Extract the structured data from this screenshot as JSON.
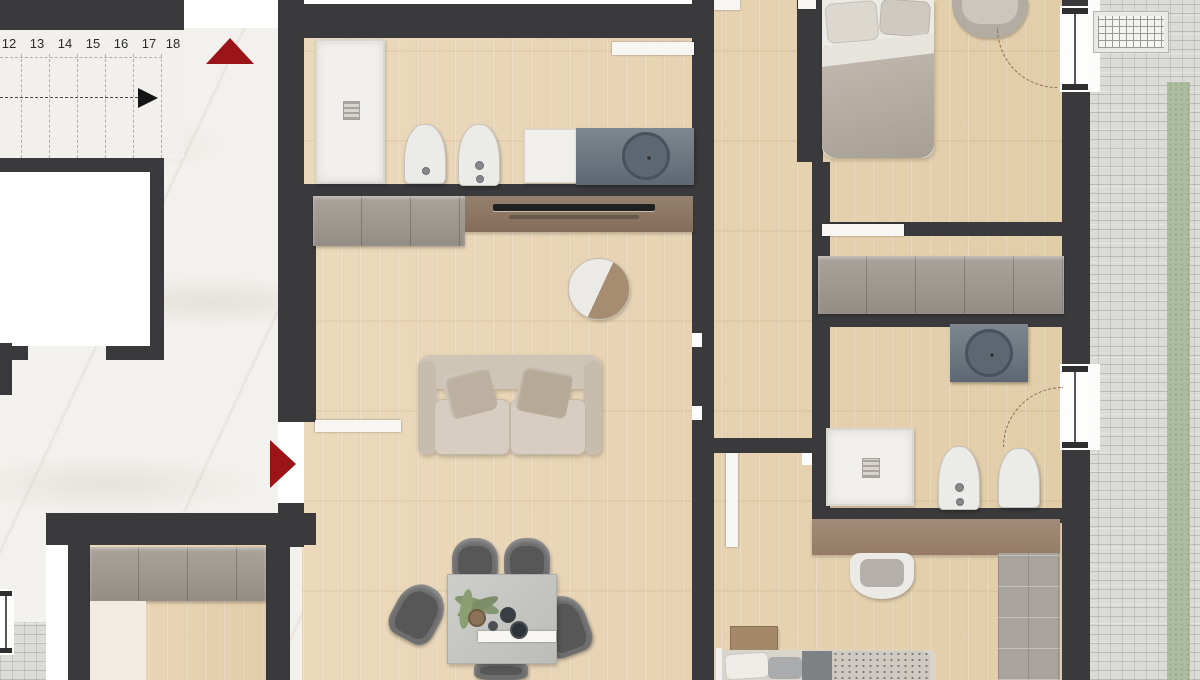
{
  "title": "apartment-floor-plan",
  "palette": {
    "wall": "#3a3a3c",
    "wood_floor": "#e7d3b4",
    "marble_floor": "#f3f1ed",
    "paver": "#dbdbd7",
    "grass": "#abbd9e",
    "accent_red": "#9b1418",
    "cabinet_gray": "#a19a92",
    "media_brown": "#8d7866",
    "vanity_gray": "#6f7983",
    "tile_gray": "#a8a39d",
    "door_white": "#f7f6f3"
  },
  "stairs": {
    "numbers": [
      "12",
      "13",
      "14",
      "15",
      "16",
      "17",
      "18"
    ],
    "direction_arrow": "black-right-arrow",
    "up_indicator": "red-up-triangle"
  },
  "entry": {
    "indicator": "red-right-triangle"
  },
  "fixtures": {
    "bathroom_top": [
      "shower-tray",
      "toilet",
      "bidet",
      "cabinet",
      "vanity-basin"
    ],
    "living": [
      "wardrobe",
      "tv-media-wall",
      "round-mirror",
      "sofa",
      "dining-table",
      "dining-chairs",
      "plant"
    ],
    "bedroom_top_right": [
      "double-bed",
      "armchair",
      "door-swing"
    ],
    "closet_room": [
      "wardrobe"
    ],
    "bathroom_right": [
      "vanity-basin",
      "shower-tray",
      "bidet",
      "toilet",
      "door-swing"
    ],
    "bedroom_bottom_right": [
      "desk-shelf",
      "chair",
      "bed",
      "nightstand",
      "rug"
    ],
    "unit_lower_left": [
      "wardrobe"
    ],
    "common": [
      "elevator",
      "staircase",
      "paved-walkway",
      "grass-strip",
      "drain-grate"
    ]
  }
}
